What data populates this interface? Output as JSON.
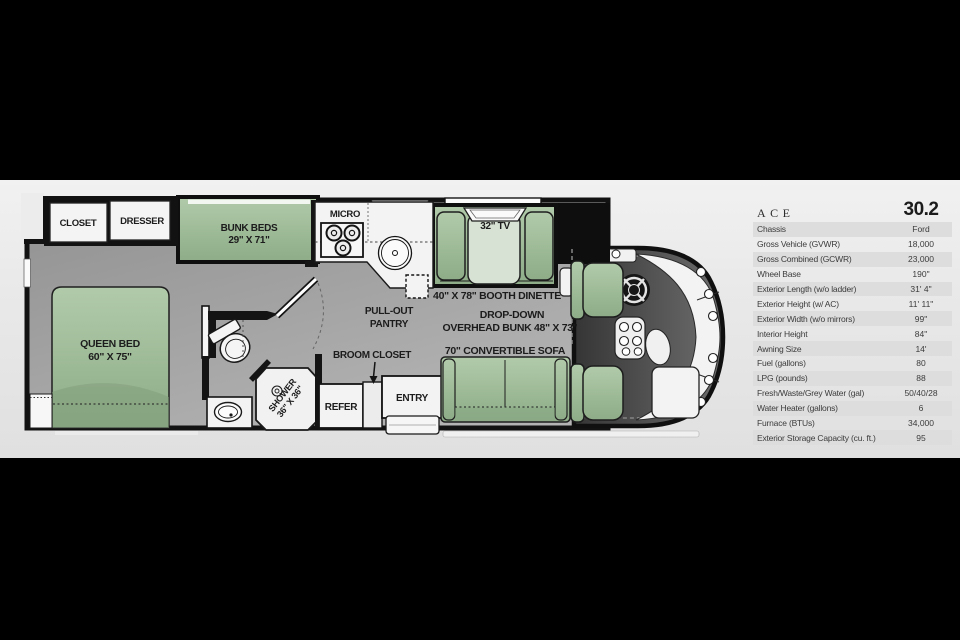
{
  "specs": {
    "series": "ACE",
    "model": "30.2",
    "rows": [
      {
        "label": "Chassis",
        "value": "Ford"
      },
      {
        "label": "Gross Vehicle (GVWR)",
        "value": "18,000"
      },
      {
        "label": "Gross Combined (GCWR)",
        "value": "23,000"
      },
      {
        "label": "Wheel Base",
        "value": "190\""
      },
      {
        "label": "Exterior Length (w/o ladder)",
        "value": "31' 4\""
      },
      {
        "label": "Exterior Height (w/ AC)",
        "value": "11' 11\""
      },
      {
        "label": "Exterior Width (w/o mirrors)",
        "value": "99\""
      },
      {
        "label": "Interior Height",
        "value": "84\""
      },
      {
        "label": "Awning Size",
        "value": "14'"
      },
      {
        "label": "Fuel (gallons)",
        "value": "80"
      },
      {
        "label": "LPG (pounds)",
        "value": "88"
      },
      {
        "label": "Fresh/Waste/Grey Water (gal)",
        "value": "50/40/28"
      },
      {
        "label": "Water Heater (gallons)",
        "value": "6"
      },
      {
        "label": "Furnace (BTUs)",
        "value": "34,000"
      },
      {
        "label": "Exterior Storage Capacity (cu. ft.)",
        "value": "95"
      }
    ]
  },
  "floorplan": {
    "labels": {
      "closet": "CLOSET",
      "dresser": "DRESSER",
      "bunk_line1": "BUNK BEDS",
      "bunk_line2": "29\" X 71\"",
      "micro": "MICRO",
      "tv": "32\" TV",
      "dinette": "40\" X 78\" BOOTH DINETTE",
      "dropdown_line1": "DROP-DOWN",
      "dropdown_line2": "OVERHEAD BUNK 48\" X 73\"",
      "sofa": "70\" CONVERTIBLE SOFA",
      "pantry_line1": "PULL-OUT",
      "pantry_line2": "PANTRY",
      "broom": "BROOM CLOSET",
      "refer": "REFER",
      "entry": "ENTRY",
      "queen_line1": "QUEEN BED",
      "queen_line2": "60\" X 75\"",
      "shower_line1": "SHOWER",
      "shower_line2": "36\" X 36\""
    },
    "colors": {
      "furniture_green": "#9fbf9a",
      "wall_black": "#121212",
      "floor_gray": "#a0a0a0"
    }
  }
}
